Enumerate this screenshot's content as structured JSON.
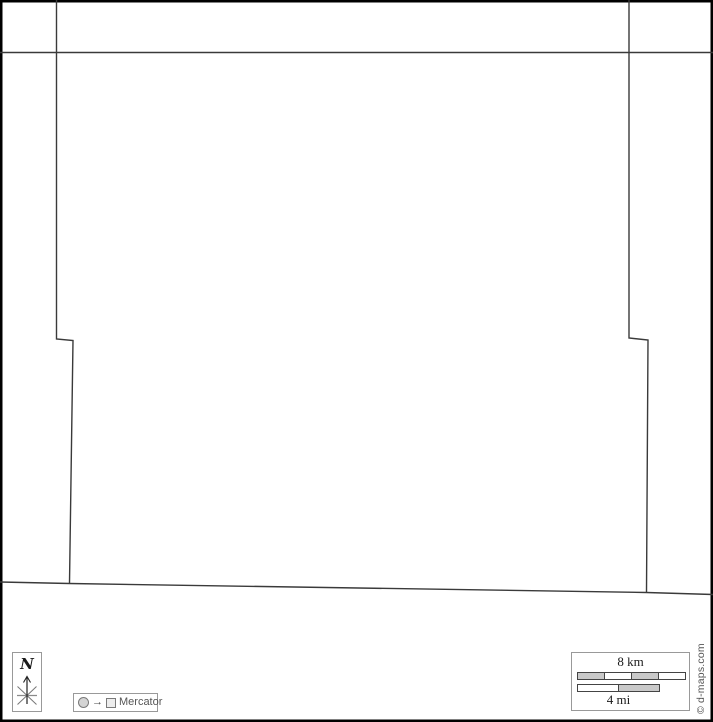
{
  "map": {
    "background_color": "#ffffff",
    "frame_color": "#000000",
    "outline_color": "#3a3a3a",
    "boundary_lines": [
      {
        "name": "north-boundary-line",
        "points": "0,52.5 713,52.5"
      },
      {
        "name": "west-boundary-line",
        "points": "56.5,0 56.5,339 73,340.5 69.5,583"
      },
      {
        "name": "east-boundary-line",
        "points": "629,0 629,338 648,340 646.5,592.5"
      },
      {
        "name": "south-boundary-line",
        "points": "0,582 69.5,583.5 646.5,592.5 713,594.5"
      }
    ]
  },
  "compass": {
    "north_label": "N"
  },
  "projection": {
    "arrow_glyph": "→",
    "label": "Mercator"
  },
  "scale_bar": {
    "km_label": "8 km",
    "mi_label": "4 mi",
    "km_segment_colors": [
      "#c9c9c9",
      "#ffffff",
      "#c9c9c9",
      "#ffffff"
    ],
    "mi_segment_colors": [
      "#ffffff",
      "#c9c9c9"
    ]
  },
  "copyright_label": "© d-maps.com"
}
